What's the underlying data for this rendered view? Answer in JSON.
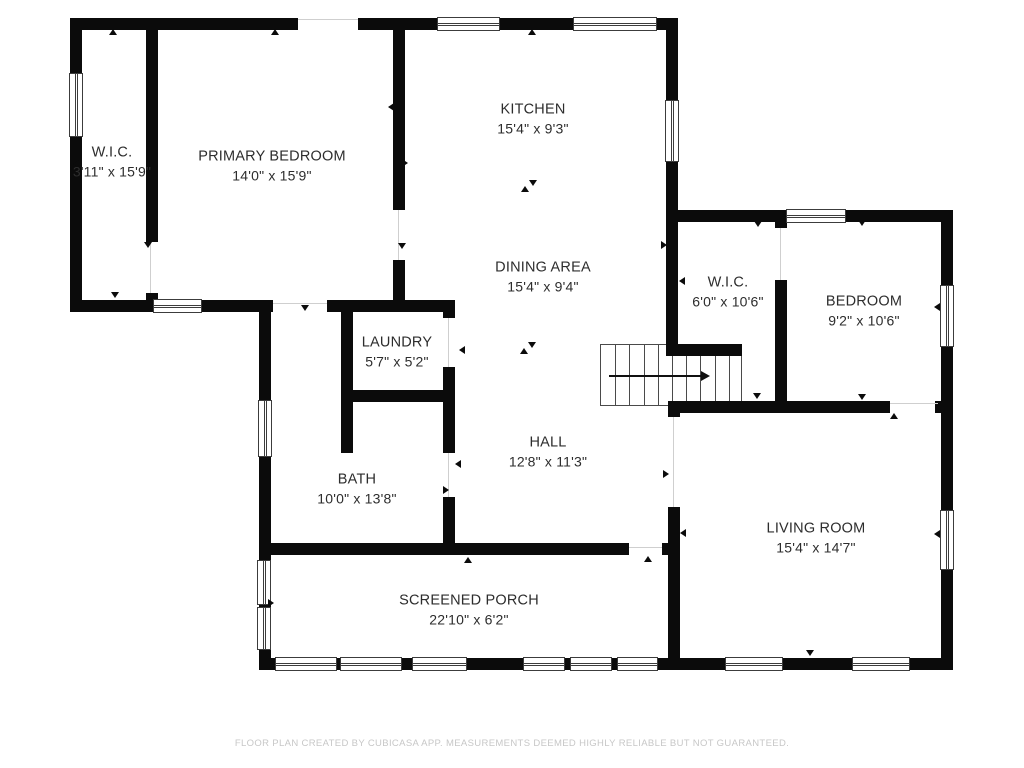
{
  "colors": {
    "wall": "#0b0b0b",
    "background": "#ffffff",
    "thin_line": "#3c3c3c",
    "door_line": "#cfcfcf",
    "label_text": "#2d2d2d",
    "footer_text": "#c7c7c7"
  },
  "rooms": [
    {
      "id": "wic-1",
      "name": "W.I.C.",
      "dims": "3'11\" x 15'9\"",
      "cx": 112,
      "cy": 162
    },
    {
      "id": "primary-bedroom",
      "name": "PRIMARY BEDROOM",
      "dims": "14'0\" x 15'9\"",
      "cx": 272,
      "cy": 166
    },
    {
      "id": "kitchen",
      "name": "KITCHEN",
      "dims": "15'4\" x 9'3\"",
      "cx": 533,
      "cy": 119
    },
    {
      "id": "dining-area",
      "name": "DINING AREA",
      "dims": "15'4\" x 9'4\"",
      "cx": 543,
      "cy": 277
    },
    {
      "id": "wic-2",
      "name": "W.I.C.",
      "dims": "6'0\" x 10'6\"",
      "cx": 728,
      "cy": 292
    },
    {
      "id": "bedroom",
      "name": "BEDROOM",
      "dims": "9'2\" x 10'6\"",
      "cx": 864,
      "cy": 311
    },
    {
      "id": "laundry",
      "name": "LAUNDRY",
      "dims": "5'7\" x 5'2\"",
      "cx": 397,
      "cy": 352
    },
    {
      "id": "hall",
      "name": "HALL",
      "dims": "12'8\" x 11'3\"",
      "cx": 548,
      "cy": 452
    },
    {
      "id": "bath",
      "name": "BATH",
      "dims": "10'0\" x 13'8\"",
      "cx": 357,
      "cy": 489
    },
    {
      "id": "living-room",
      "name": "LIVING ROOM",
      "dims": "15'4\" x 14'7\"",
      "cx": 816,
      "cy": 538
    },
    {
      "id": "screened-porch",
      "name": "SCREENED PORCH",
      "dims": "22'10\" x 6'2\"",
      "cx": 469,
      "cy": 610
    }
  ],
  "walls": [
    [
      70,
      18,
      228,
      12
    ],
    [
      358,
      18,
      320,
      12
    ],
    [
      70,
      18,
      12,
      294
    ],
    [
      146,
      18,
      12,
      224
    ],
    [
      146,
      293,
      12,
      19
    ],
    [
      70,
      300,
      203,
      12
    ],
    [
      327,
      300,
      128,
      12
    ],
    [
      393,
      18,
      12,
      192
    ],
    [
      393,
      260,
      12,
      52
    ],
    [
      666,
      18,
      12,
      338
    ],
    [
      666,
      210,
      287,
      12
    ],
    [
      941,
      210,
      12,
      460
    ],
    [
      775,
      210,
      12,
      18
    ],
    [
      775,
      280,
      12,
      126
    ],
    [
      666,
      344,
      76,
      12
    ],
    [
      670,
      401,
      220,
      12
    ],
    [
      935,
      401,
      18,
      12
    ],
    [
      668,
      401,
      12,
      16
    ],
    [
      668,
      507,
      12,
      163
    ],
    [
      259,
      543,
      370,
      12
    ],
    [
      662,
      543,
      18,
      12
    ],
    [
      259,
      300,
      12,
      243
    ],
    [
      259,
      543,
      12,
      127
    ],
    [
      341,
      312,
      12,
      141
    ],
    [
      341,
      390,
      114,
      12
    ],
    [
      443,
      300,
      12,
      18
    ],
    [
      443,
      367,
      12,
      86
    ],
    [
      443,
      497,
      12,
      46
    ],
    [
      259,
      658,
      694,
      12
    ]
  ],
  "windows": [
    {
      "x": 437,
      "y": 17,
      "w": 63,
      "h": 14,
      "o": "h"
    },
    {
      "x": 573,
      "y": 17,
      "w": 84,
      "h": 14,
      "o": "h"
    },
    {
      "x": 69,
      "y": 73,
      "w": 14,
      "h": 64,
      "o": "v"
    },
    {
      "x": 153,
      "y": 299,
      "w": 49,
      "h": 14,
      "o": "h"
    },
    {
      "x": 665,
      "y": 100,
      "w": 14,
      "h": 62,
      "o": "v"
    },
    {
      "x": 786,
      "y": 209,
      "w": 60,
      "h": 14,
      "o": "h"
    },
    {
      "x": 940,
      "y": 285,
      "w": 14,
      "h": 62,
      "o": "v"
    },
    {
      "x": 940,
      "y": 510,
      "w": 14,
      "h": 60,
      "o": "v"
    },
    {
      "x": 258,
      "y": 400,
      "w": 14,
      "h": 57,
      "o": "v"
    },
    {
      "x": 257,
      "y": 560,
      "w": 14,
      "h": 45,
      "o": "v"
    },
    {
      "x": 257,
      "y": 607,
      "w": 14,
      "h": 43,
      "o": "v"
    },
    {
      "x": 275,
      "y": 657,
      "w": 62,
      "h": 14,
      "o": "h"
    },
    {
      "x": 340,
      "y": 657,
      "w": 62,
      "h": 14,
      "o": "h"
    },
    {
      "x": 412,
      "y": 657,
      "w": 55,
      "h": 14,
      "o": "h"
    },
    {
      "x": 523,
      "y": 657,
      "w": 42,
      "h": 14,
      "o": "h"
    },
    {
      "x": 570,
      "y": 657,
      "w": 42,
      "h": 14,
      "o": "h"
    },
    {
      "x": 617,
      "y": 657,
      "w": 41,
      "h": 14,
      "o": "h"
    },
    {
      "x": 725,
      "y": 657,
      "w": 58,
      "h": 14,
      "o": "h"
    },
    {
      "x": 852,
      "y": 657,
      "w": 58,
      "h": 14,
      "o": "h"
    }
  ],
  "door_openings": [
    [
      298,
      19,
      60,
      1
    ],
    [
      273,
      303,
      54,
      1
    ],
    [
      890,
      403,
      48,
      1
    ],
    [
      629,
      547,
      33,
      1
    ],
    [
      150,
      242,
      1,
      51
    ],
    [
      398,
      210,
      1,
      50
    ],
    [
      448,
      318,
      1,
      49
    ],
    [
      448,
      453,
      1,
      44
    ],
    [
      780,
      228,
      1,
      52
    ],
    [
      673,
      417,
      1,
      90
    ]
  ],
  "ticks": [
    [
      113,
      33,
      "up"
    ],
    [
      275,
      33,
      "up"
    ],
    [
      532,
      33,
      "up"
    ],
    [
      648,
      560,
      "up"
    ],
    [
      468,
      561,
      "up"
    ],
    [
      894,
      417,
      "up"
    ],
    [
      525,
      190,
      "up"
    ],
    [
      524,
      352,
      "up"
    ],
    [
      148,
      246,
      "down"
    ],
    [
      402,
      247,
      "down"
    ],
    [
      305,
      309,
      "down"
    ],
    [
      758,
      225,
      "down"
    ],
    [
      862,
      224,
      "down"
    ],
    [
      757,
      397,
      "down"
    ],
    [
      862,
      398,
      "down"
    ],
    [
      810,
      654,
      "down"
    ],
    [
      115,
      296,
      "down"
    ],
    [
      533,
      184,
      "down"
    ],
    [
      532,
      346,
      "down"
    ],
    [
      665,
      245,
      "right"
    ],
    [
      667,
      474,
      "right"
    ],
    [
      351,
      351,
      "right"
    ],
    [
      447,
      490,
      "right"
    ],
    [
      272,
      603,
      "right"
    ],
    [
      406,
      163,
      "right"
    ],
    [
      683,
      281,
      "left"
    ],
    [
      684,
      533,
      "left"
    ],
    [
      938,
      307,
      "left"
    ],
    [
      938,
      534,
      "left"
    ],
    [
      463,
      350,
      "left"
    ],
    [
      459,
      464,
      "left"
    ],
    [
      392,
      107,
      "left"
    ],
    [
      77,
      164,
      "left"
    ]
  ],
  "stairs": {
    "x": 600,
    "y": 344,
    "w": 142,
    "h": 62,
    "treads": 10,
    "arrow_x1": 8,
    "arrow_x2": 100,
    "arrow_y": 30
  },
  "footer": {
    "text": "FLOOR PLAN CREATED BY CUBICASA APP. MEASUREMENTS DEEMED HIGHLY RELIABLE BUT NOT GUARANTEED.",
    "y": 738
  }
}
